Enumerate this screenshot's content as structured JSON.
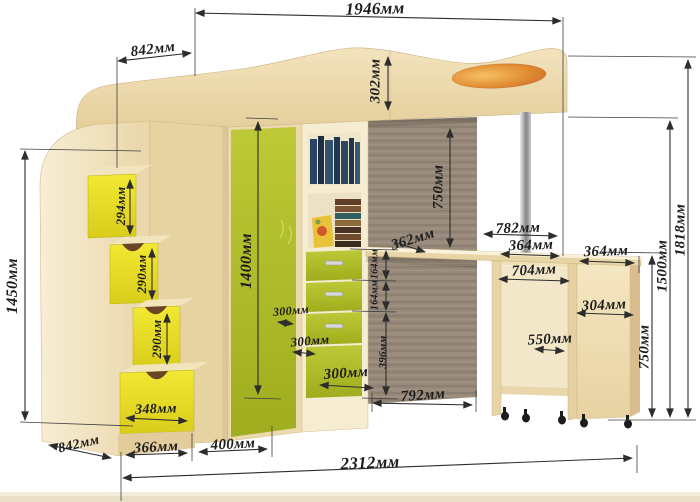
{
  "diagram": {
    "type": "furniture-dimension-drawing",
    "unit": "мм",
    "labels": {
      "bed_length": "1946мм",
      "head_depth_top": "842мм",
      "rail_height": "302мм",
      "stairs_height": "1450мм",
      "step_drawer_1": "294мм",
      "step_drawer_2": "290мм",
      "step_drawer_3": "290мм",
      "base_drawer_width": "348мм",
      "wardrobe_height": "1400мм",
      "bed_clearance": "750мм",
      "desk_board_depth": "362мм",
      "drawer_height_1": "164мм",
      "drawer_height_2": "164мм",
      "lower_front_height": "396мм",
      "shelf_depth_a": "300мм",
      "shelf_depth_b": "300мм",
      "drawer_width": "300мм",
      "desk_length": "792мм",
      "total_width": "2312мм",
      "side_depth_bottom": "842мм",
      "front_section_a": "366мм",
      "front_section_b": "400мм",
      "bed_overhang": "782мм",
      "shelf_width_a": "364мм",
      "shelf_width_b": "364мм",
      "table_interior_width": "704мм",
      "cabinet_width": "304мм",
      "table_inner_depth": "550мм",
      "table_height": "750мм",
      "shelf_height": "1500мм",
      "total_height": "1818мм"
    },
    "colors": {
      "wood_light": "#f2e5c2",
      "wood_mid": "#e9d6a8",
      "green_accent": "#b5c12d",
      "yellow_accent": "#ece528",
      "orange_inlay": "#d96b2a",
      "back_panel": "#95887a",
      "dimension_ink": "#2d2d2d"
    }
  }
}
